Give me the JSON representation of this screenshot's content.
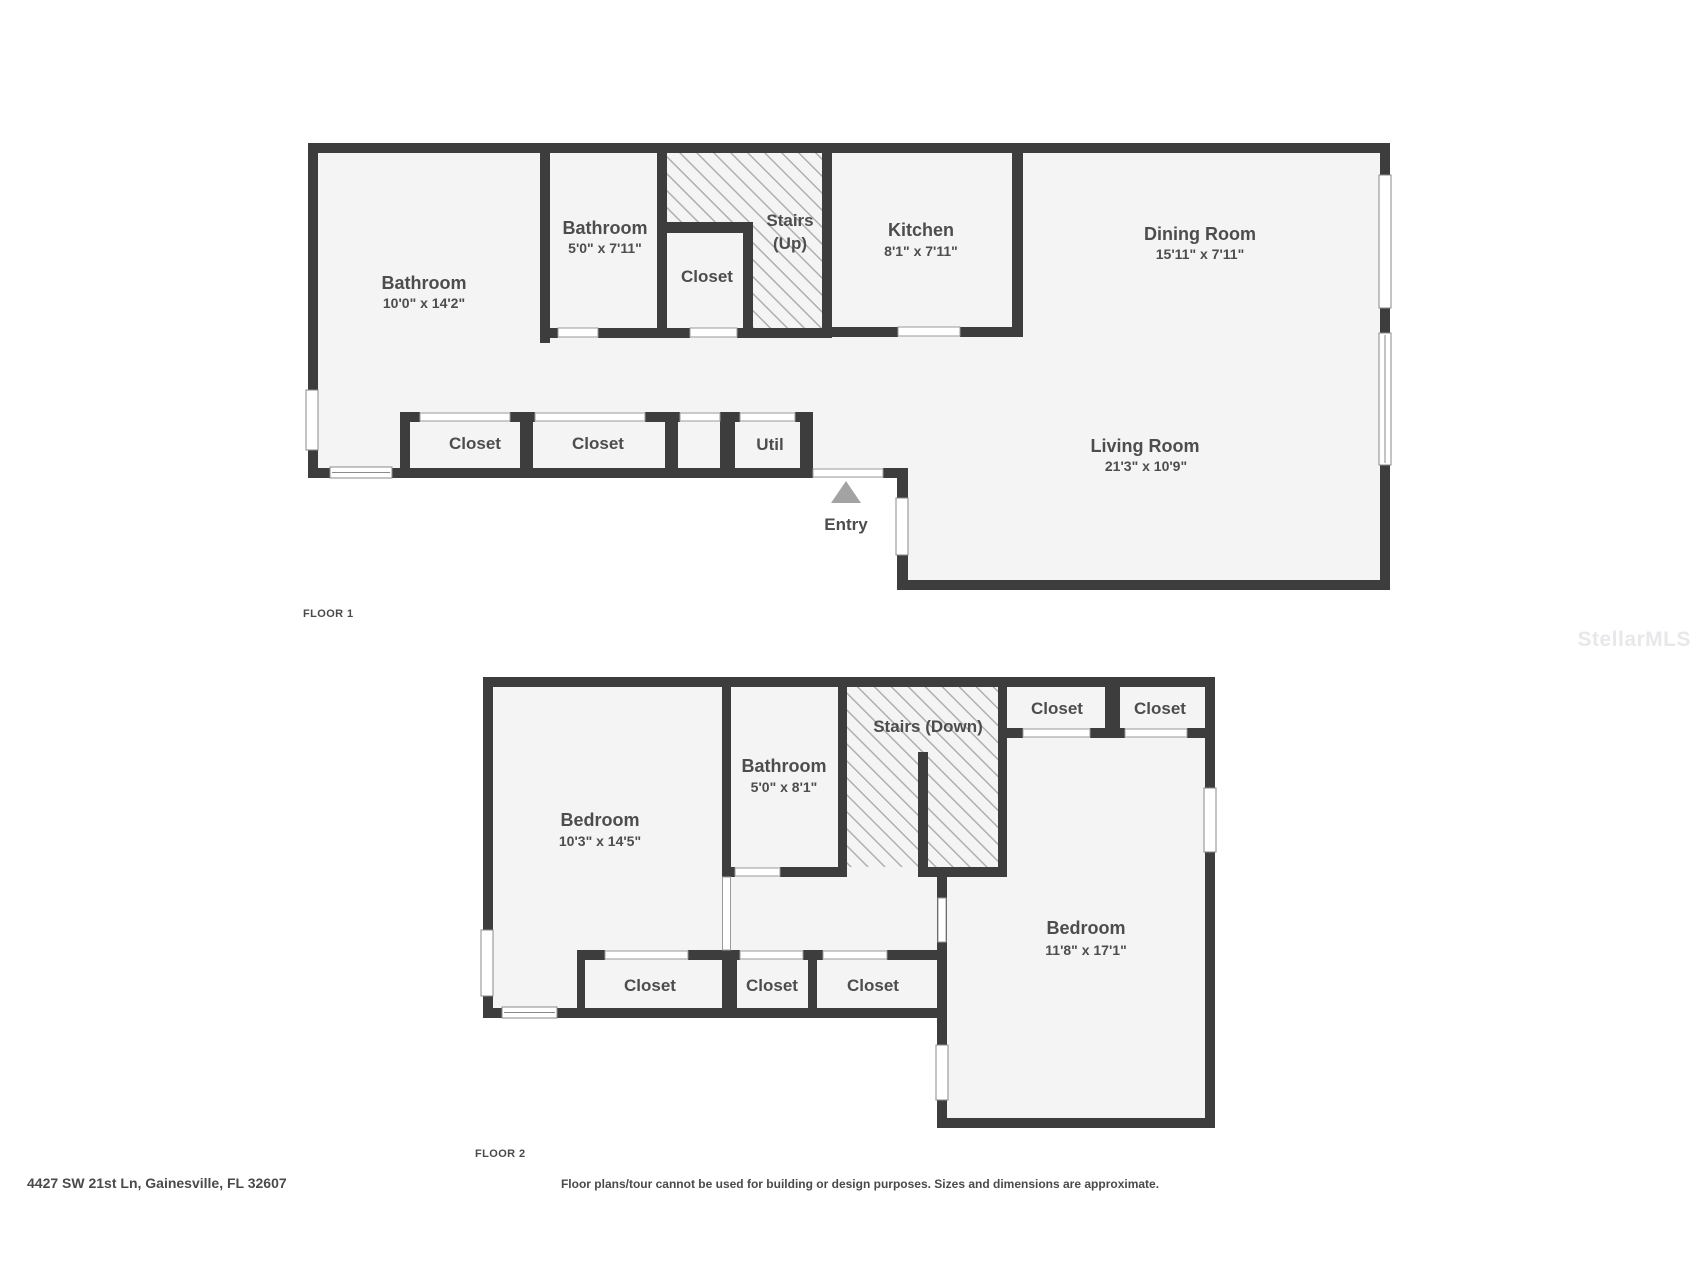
{
  "page": {
    "title": "Floor plan"
  },
  "colors": {
    "wall": "#3d3d3d",
    "floor_fill": "#f4f4f5",
    "hatch_line": "#ababab",
    "label_text": "#4d4d4d",
    "window_outline": "#8a8a8a",
    "entry_arrow": "#a3a3a3",
    "watermark": "#e8e8ec",
    "background": "#ffffff"
  },
  "watermark": {
    "text": "StellarMLS"
  },
  "footer": {
    "address": "4427 SW 21st Ln, Gainesville, FL 32607",
    "disclaimer": "Floor plans/tour cannot be used for building or design purposes. Sizes and dimensions are approximate."
  },
  "floor1": {
    "label": "FLOOR 1",
    "rooms": {
      "bathroom_main": {
        "name": "Bathroom",
        "dims": "10'0\" x 14'2\""
      },
      "bathroom_hall": {
        "name": "Bathroom",
        "dims": "5'0\" x 7'11\""
      },
      "closet_hall": {
        "name": "Closet"
      },
      "stairs": {
        "name": "Stairs (Up)",
        "line1": "Stairs",
        "line2": "(Up)"
      },
      "kitchen": {
        "name": "Kitchen",
        "dims": "8'1\" x 7'11\""
      },
      "dining": {
        "name": "Dining Room",
        "dims": "15'11\" x 7'11\""
      },
      "living": {
        "name": "Living Room",
        "dims": "21'3\" x 10'9\""
      },
      "closet_row_1": {
        "name": "Closet"
      },
      "closet_row_2": {
        "name": "Closet"
      },
      "util": {
        "name": "Util"
      },
      "entry": {
        "name": "Entry"
      }
    }
  },
  "floor2": {
    "label": "FLOOR 2",
    "rooms": {
      "bedroom_left": {
        "name": "Bedroom",
        "dims": "10'3\" x 14'5\""
      },
      "bathroom": {
        "name": "Bathroom",
        "dims": "5'0\" x 8'1\""
      },
      "stairs": {
        "name": "Stairs (Down)"
      },
      "closet_top_1": {
        "name": "Closet"
      },
      "closet_top_2": {
        "name": "Closet"
      },
      "bedroom_right": {
        "name": "Bedroom",
        "dims": "11'8\" x 17'1\""
      },
      "closet_bottom_1": {
        "name": "Closet"
      },
      "closet_bottom_2": {
        "name": "Closet"
      },
      "closet_bottom_3": {
        "name": "Closet"
      }
    }
  }
}
